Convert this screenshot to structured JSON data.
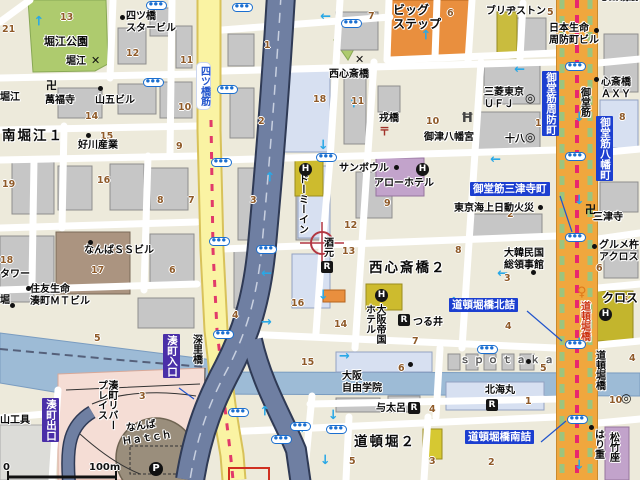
{
  "map": {
    "labels": {
      "horie_park": "堀江公園",
      "yotsubashi_star_bldg": "四ツ橋\nスタービル",
      "horie_crossing": "堀江",
      "manpukuji": "萬福寺",
      "yamago_bldg": "山五ビル",
      "minami_horie_1": "南堀江１",
      "yoshikawa_sangyo": "好川産業",
      "horie_left": "堀江",
      "yotsubashisuji": "四ツ橋筋",
      "big_step": "ビッグ\nステップ",
      "bridgestone": "ブリヂストン",
      "nissay_suomachi_bldg": "日本生命\n周防町ビル",
      "nishi_shinsaibashi_crossing": "西心斎橋",
      "ebisubashi": "戎橋",
      "mitsu_hachimangu": "御津八幡宮",
      "mitsubishi_ufj": "三菱東京\n ＵＦＪ",
      "juhachi": "十八",
      "shinsaibashi_axy": "心斎橋\nＡＸＹ",
      "midosuji": "御堂筋",
      "midosuji_suomachi": "御堂筋周防町",
      "midosuji_hachimancho": "御堂筋八幡町",
      "shinsaibashisuji_clipped": "心斎橋筋",
      "mitsutera": "三津寺",
      "sun_bowl": "サンボウル",
      "arrow_hotel": "アローホテル",
      "dormy_inn": "ドーミーイン",
      "midosuji_mitsuteracho": "御堂筋三津寺町",
      "tokio_marine": "東京海上日動火災",
      "sakemoto": "酒元",
      "nishi_shinsaibashi_2": "西心斎橋２",
      "korea_consulate": "大韓民国\n総領事館",
      "gourmet_across": "グルメ杵\nアクロス",
      "cross_hotel": "クロス",
      "osaka_teikoku_hotel": "大阪帝国\nホテル",
      "tsurui": "つる井",
      "dotonboribashi_kitazume": "道頓堀橋北詰",
      "osaka_jiyu_gakuin": "大阪\n自由学院",
      "spotaka": "ｓｐｏｔａｋａ",
      "hokkaimaru": "北海丸",
      "yotaro": "与太呂",
      "dotonbori_2": "道頓堀２",
      "dotonboribashi_minamizume": "道頓堀橋南詰",
      "dotonboribashi_on_road": "道頓堀橋",
      "dotonboribashi_east": "道頓堀橋",
      "harijyu": "はり重",
      "shochikuza": "松竹座",
      "fukaribashi": "深里橋",
      "minatomachi_entrance": "湊町入口",
      "minatomachi_exit": "湊町出口",
      "minatomachi_river_place": "湊町リバー\nプレイス",
      "namba_ss_bldg": "なんばＳＳビル",
      "sumitomo_mt_bldg": "住友生命\n湊町ＭＴビル",
      "tower_clipped": "タワー",
      "hori_clipped": "堀",
      "yama_kogu": "山工具",
      "namba": "なんば",
      "hatch": "Ｈａｔｃｈ"
    },
    "scale": {
      "zero": "0",
      "distance": "100m"
    },
    "colors": {
      "arterial_orange": "#F0A73E",
      "arterial_yellow": "#FAF3A3",
      "expressway": "#6F7FA2",
      "river": "#9DBBD6",
      "park": "#AECB6E",
      "label_blue": "#1C3FD0",
      "arrow_cyan": "#29A8E6",
      "crosshair_red": "#B23742"
    },
    "numbers": [
      {
        "t": "13",
        "x": 60,
        "y": 12
      },
      {
        "t": "21",
        "x": 2,
        "y": 24
      },
      {
        "t": "12",
        "x": 126,
        "y": 48
      },
      {
        "t": "11",
        "x": 180,
        "y": 55
      },
      {
        "t": "10",
        "x": 178,
        "y": 102
      },
      {
        "t": "14",
        "x": 85,
        "y": 111
      },
      {
        "t": "15",
        "x": 100,
        "y": 131
      },
      {
        "t": "9",
        "x": 176,
        "y": 141
      },
      {
        "t": "19",
        "x": 2,
        "y": 179
      },
      {
        "t": "16",
        "x": 97,
        "y": 175
      },
      {
        "t": "8",
        "x": 157,
        "y": 195
      },
      {
        "t": "7",
        "x": 188,
        "y": 195
      },
      {
        "t": "18",
        "x": 0,
        "y": 255
      },
      {
        "t": "17",
        "x": 91,
        "y": 265
      },
      {
        "t": "6",
        "x": 169,
        "y": 265
      },
      {
        "t": "5",
        "x": 94,
        "y": 333
      },
      {
        "t": "3",
        "x": 139,
        "y": 391
      },
      {
        "t": "7",
        "x": 368,
        "y": 11
      },
      {
        "t": "6",
        "x": 447,
        "y": 8
      },
      {
        "t": "5",
        "x": 547,
        "y": 7
      },
      {
        "t": "1",
        "x": 264,
        "y": 40
      },
      {
        "t": "2",
        "x": 258,
        "y": 116
      },
      {
        "t": "18",
        "x": 313,
        "y": 94
      },
      {
        "t": "11",
        "x": 351,
        "y": 96
      },
      {
        "t": "10",
        "x": 426,
        "y": 116
      },
      {
        "t": "1",
        "x": 535,
        "y": 118
      },
      {
        "t": "8",
        "x": 619,
        "y": 112
      },
      {
        "t": "3",
        "x": 250,
        "y": 195
      },
      {
        "t": "9",
        "x": 384,
        "y": 198
      },
      {
        "t": "12",
        "x": 344,
        "y": 220
      },
      {
        "t": "13",
        "x": 342,
        "y": 246
      },
      {
        "t": "2",
        "x": 507,
        "y": 209
      },
      {
        "t": "8",
        "x": 455,
        "y": 245
      },
      {
        "t": "3",
        "x": 504,
        "y": 273
      },
      {
        "t": "6",
        "x": 596,
        "y": 263
      },
      {
        "t": "16",
        "x": 291,
        "y": 298
      },
      {
        "t": "4",
        "x": 232,
        "y": 310
      },
      {
        "t": "14",
        "x": 334,
        "y": 319
      },
      {
        "t": "15",
        "x": 301,
        "y": 357
      },
      {
        "t": "7",
        "x": 412,
        "y": 336
      },
      {
        "t": "6",
        "x": 398,
        "y": 363
      },
      {
        "t": "5",
        "x": 540,
        "y": 363
      },
      {
        "t": "4",
        "x": 505,
        "y": 321
      },
      {
        "t": "1",
        "x": 525,
        "y": 396
      },
      {
        "t": "10",
        "x": 609,
        "y": 395
      },
      {
        "t": "4",
        "x": 429,
        "y": 404
      },
      {
        "t": "5",
        "x": 349,
        "y": 456
      },
      {
        "t": "3",
        "x": 429,
        "y": 456
      },
      {
        "t": "2",
        "x": 488,
        "y": 457
      },
      {
        "t": "5",
        "x": 622,
        "y": 295
      },
      {
        "t": "4",
        "x": 629,
        "y": 353
      }
    ],
    "busstops": [
      {
        "x": 146,
        "y": 1
      },
      {
        "x": 232,
        "y": 3
      },
      {
        "x": 341,
        "y": 19
      },
      {
        "x": 565,
        "y": 62
      },
      {
        "x": 143,
        "y": 78
      },
      {
        "x": 217,
        "y": 85
      },
      {
        "x": 316,
        "y": 153
      },
      {
        "x": 211,
        "y": 158
      },
      {
        "x": 565,
        "y": 152
      },
      {
        "x": 209,
        "y": 237
      },
      {
        "x": 256,
        "y": 245
      },
      {
        "x": 565,
        "y": 233
      },
      {
        "x": 213,
        "y": 330
      },
      {
        "x": 565,
        "y": 340
      },
      {
        "x": 477,
        "y": 345
      },
      {
        "x": 228,
        "y": 408
      },
      {
        "x": 290,
        "y": 422
      },
      {
        "x": 326,
        "y": 425
      },
      {
        "x": 271,
        "y": 435
      },
      {
        "x": 567,
        "y": 415
      }
    ],
    "arrows": [
      {
        "x": 34,
        "y": 14,
        "r": -90
      },
      {
        "x": 64,
        "y": 53,
        "r": 90
      },
      {
        "x": 320,
        "y": 9,
        "r": 180
      },
      {
        "x": 421,
        "y": 28,
        "r": -90
      },
      {
        "x": 514,
        "y": 62,
        "r": 180
      },
      {
        "x": 349,
        "y": 96,
        "r": -90
      },
      {
        "x": 490,
        "y": 152,
        "r": 180
      },
      {
        "x": 265,
        "y": 170,
        "r": -90
      },
      {
        "x": 317,
        "y": 138,
        "r": 90
      },
      {
        "x": 261,
        "y": 266,
        "r": 180
      },
      {
        "x": 317,
        "y": 288,
        "r": 90
      },
      {
        "x": 497,
        "y": 266,
        "r": 180
      },
      {
        "x": 449,
        "y": 295,
        "r": -90
      },
      {
        "x": 573,
        "y": 110,
        "r": 90
      },
      {
        "x": 573,
        "y": 193,
        "r": 90
      },
      {
        "x": 573,
        "y": 336,
        "r": 90
      },
      {
        "x": 573,
        "y": 458,
        "r": 90
      },
      {
        "x": 261,
        "y": 316,
        "r": 0
      },
      {
        "x": 339,
        "y": 350,
        "r": 0
      },
      {
        "x": 327,
        "y": 408,
        "r": 90
      },
      {
        "x": 319,
        "y": 453,
        "r": 90
      },
      {
        "x": 299,
        "y": 422,
        "r": 180
      },
      {
        "x": 260,
        "y": 404,
        "r": -90
      }
    ],
    "icons": [
      {
        "k": "dot",
        "x": 120,
        "y": 15
      },
      {
        "k": "dot",
        "x": 98,
        "y": 86
      },
      {
        "k": "dot",
        "x": 86,
        "y": 133
      },
      {
        "k": "dot",
        "x": 88,
        "y": 240
      },
      {
        "k": "dot",
        "x": 26,
        "y": 286
      },
      {
        "k": "dot",
        "x": 10,
        "y": 303
      },
      {
        "k": "dot",
        "x": 394,
        "y": 165
      },
      {
        "k": "dot",
        "x": 538,
        "y": 205
      },
      {
        "k": "dot",
        "x": 531,
        "y": 270
      },
      {
        "k": "dot",
        "x": 592,
        "y": 244
      },
      {
        "k": "dot",
        "x": 594,
        "y": 77
      },
      {
        "k": "dot",
        "x": 594,
        "y": 28
      },
      {
        "k": "dot",
        "x": 408,
        "y": 362
      },
      {
        "k": "dot",
        "x": 526,
        "y": 359
      },
      {
        "k": "dot",
        "x": 589,
        "y": 425
      },
      {
        "k": "manji",
        "x": 46,
        "y": 80,
        "t": "卍"
      },
      {
        "k": "manji",
        "x": 585,
        "y": 204,
        "t": "卍"
      },
      {
        "k": "postal",
        "x": 379,
        "y": 126,
        "t": "〒"
      },
      {
        "k": "torii",
        "x": 461,
        "y": 112,
        "t": "Ħ"
      },
      {
        "k": "hicon",
        "x": 299,
        "y": 163,
        "t": "H"
      },
      {
        "k": "hicon",
        "x": 416,
        "y": 163,
        "t": "H"
      },
      {
        "k": "hicon",
        "x": 375,
        "y": 289,
        "t": "H"
      },
      {
        "k": "hicon",
        "x": 599,
        "y": 308,
        "t": "H"
      },
      {
        "k": "ricon",
        "x": 321,
        "y": 261,
        "t": "R"
      },
      {
        "k": "ricon",
        "x": 398,
        "y": 314,
        "t": "R"
      },
      {
        "k": "ricon",
        "x": 408,
        "y": 402,
        "t": "R"
      },
      {
        "k": "ricon",
        "x": 486,
        "y": 399,
        "t": "R"
      },
      {
        "k": "bank",
        "x": 525,
        "y": 92,
        "t": "◎"
      },
      {
        "k": "bank",
        "x": 525,
        "y": 131,
        "t": "◎"
      },
      {
        "k": "bank",
        "x": 621,
        "y": 392,
        "t": "◎"
      },
      {
        "k": "picon",
        "x": 149,
        "y": 462,
        "t": "P"
      },
      {
        "k": "tlight",
        "x": 577,
        "y": 286,
        "t": "♀"
      },
      {
        "k": "xmark",
        "x": 91,
        "y": 55,
        "t": "✕"
      },
      {
        "k": "xmark",
        "x": 355,
        "y": 54,
        "t": "✕"
      }
    ]
  }
}
